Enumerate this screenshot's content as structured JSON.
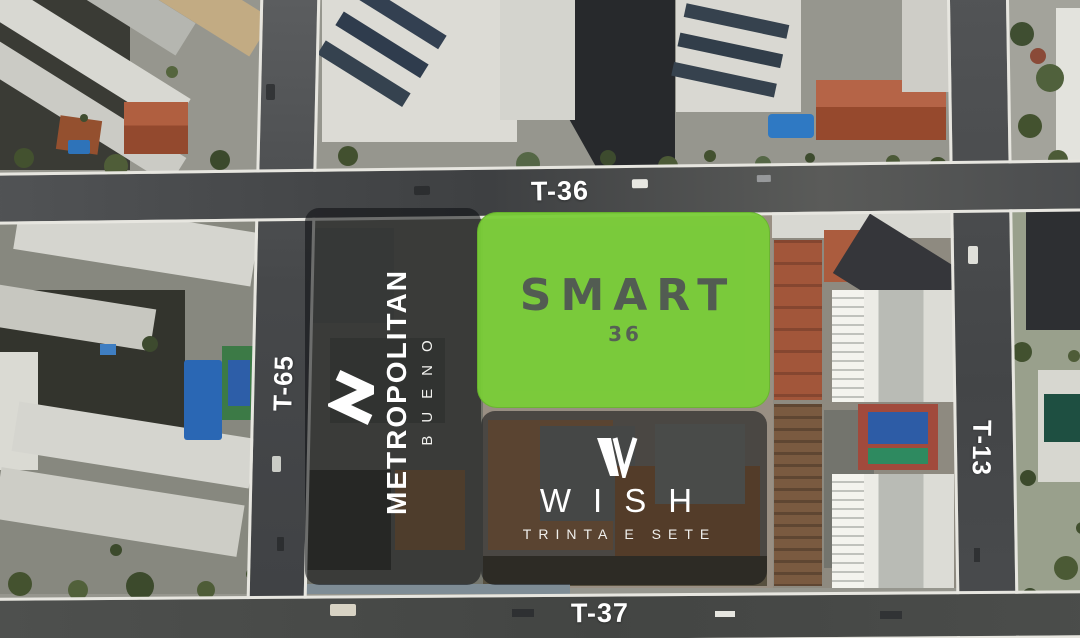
{
  "map": {
    "streets": {
      "top": "T-36",
      "left": "T-65",
      "right": "T-13",
      "bottom": "T-37"
    },
    "lots": {
      "smart": {
        "brand": "SMART",
        "unit": "36",
        "highlight_color": "#79CD37",
        "logo_text_color": "#525C52"
      },
      "metropolitan": {
        "brand": "METROPOLITAN",
        "subtitle": "BUENO",
        "icon": "metropolitan-m-chevron-icon",
        "overlay_color": "rgba(13,15,17,0.56)"
      },
      "wish": {
        "brand": "WISH",
        "subtitle": "TRINTA E SETE",
        "icon": "wish-w-mark-icon",
        "overlay_color": "rgba(13,15,17,0.56)"
      }
    }
  }
}
